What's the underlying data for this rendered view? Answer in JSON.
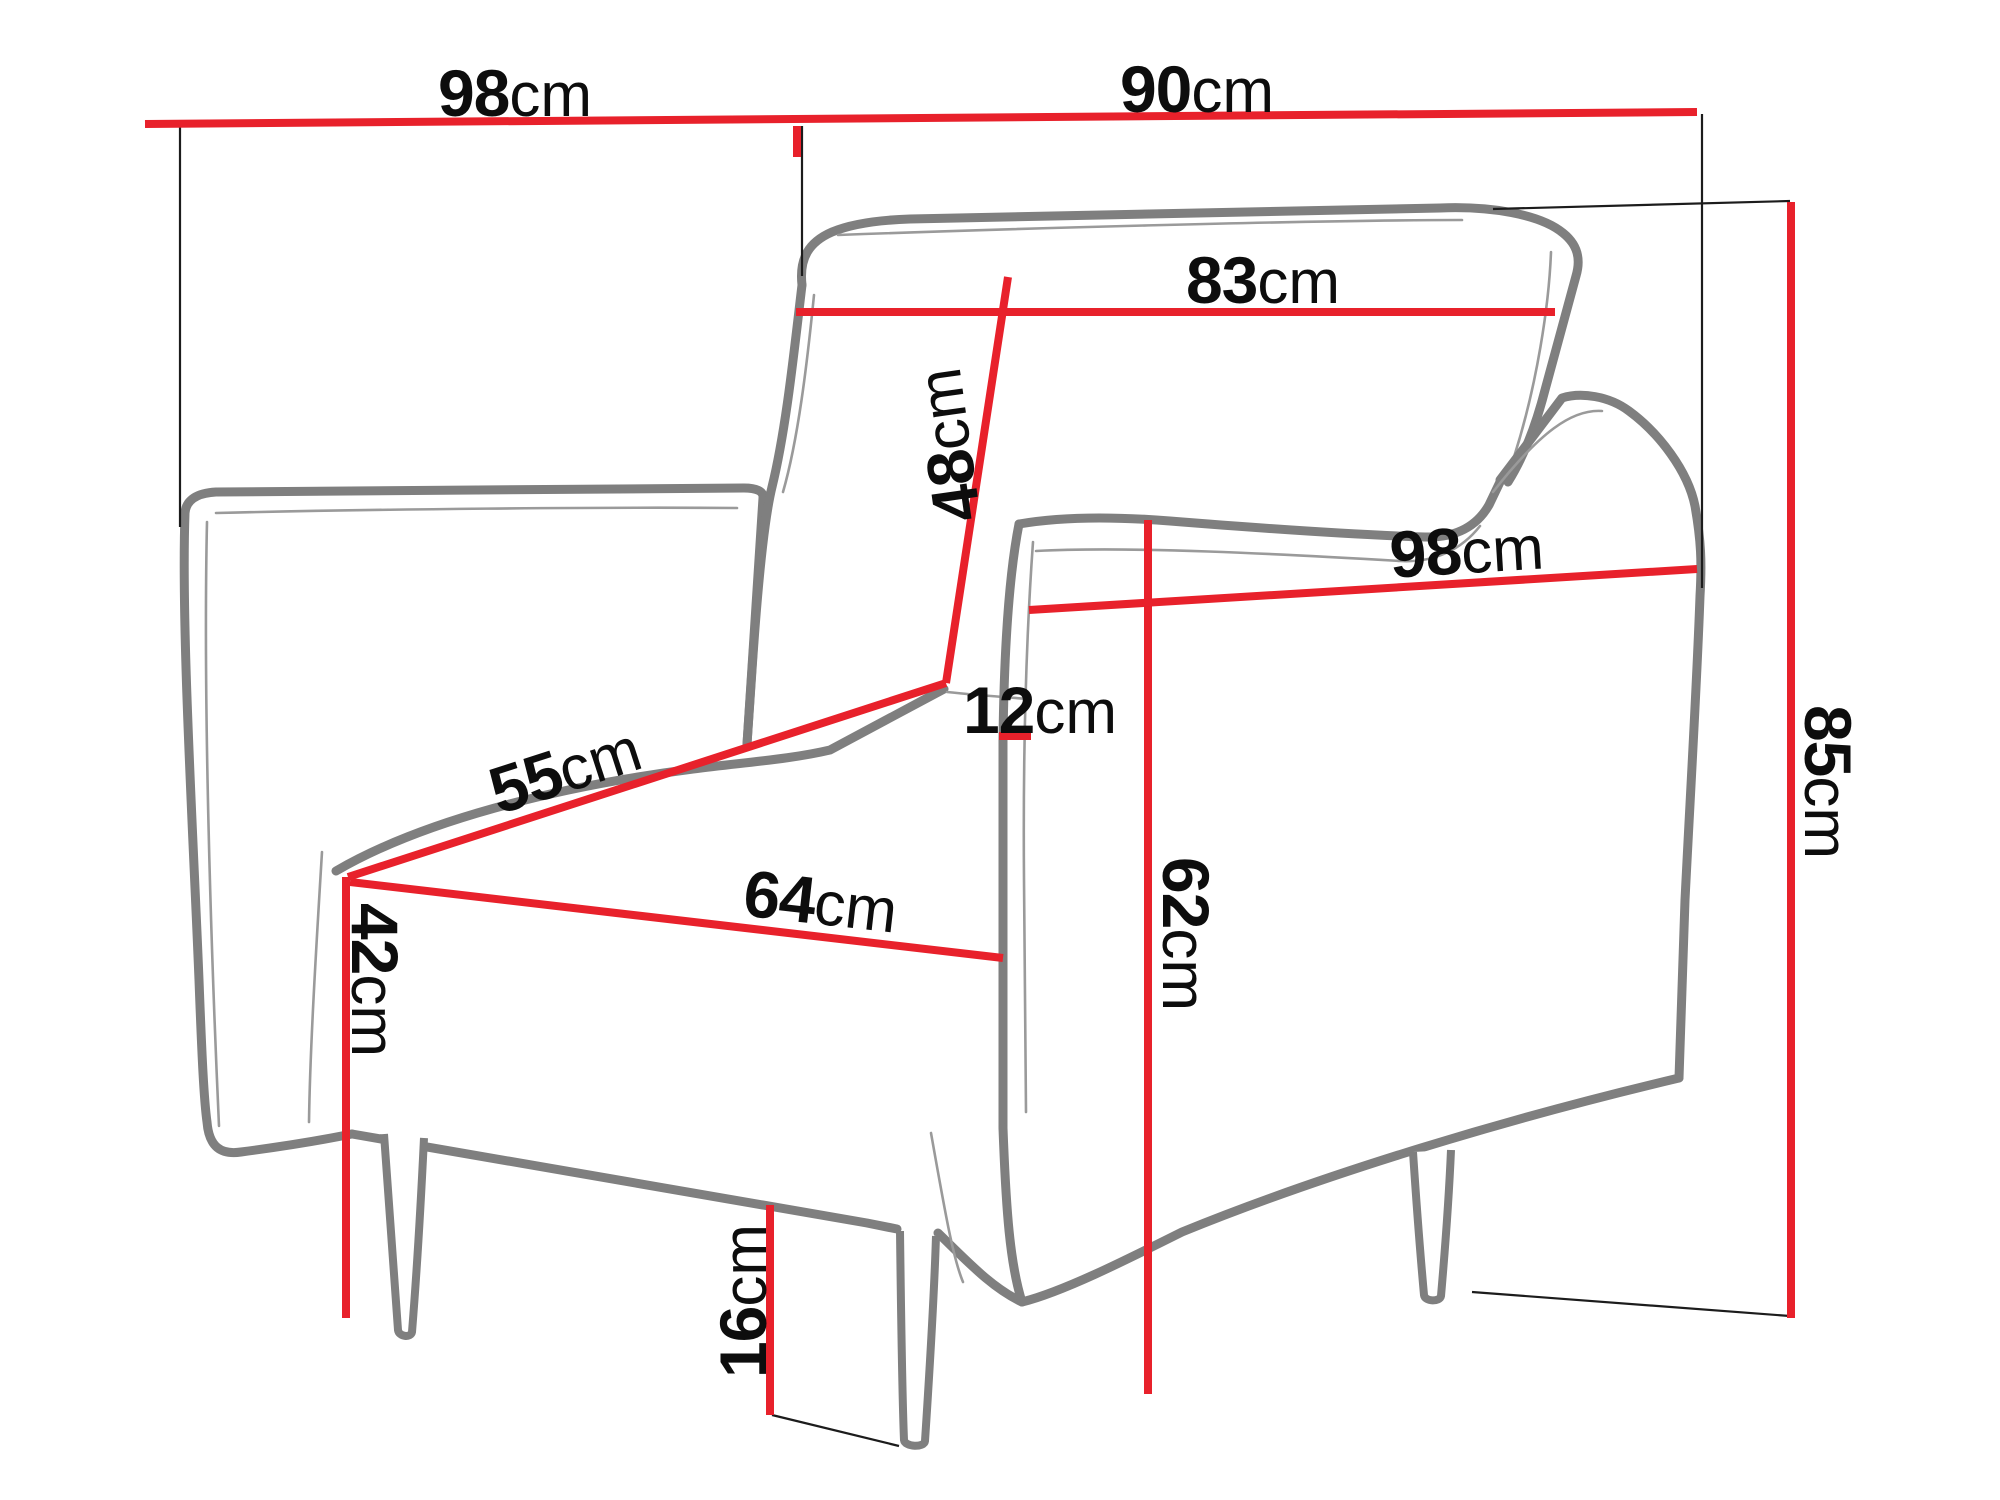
{
  "diagram": {
    "subject": "armchair-dimension-drawing",
    "unit": "cm",
    "colors": {
      "dimension_line": "#e8212b",
      "furniture_outline": "#7f7f7f",
      "extension_line": "#1c1c1c",
      "label_text": "#0d0d0d",
      "background": "#ffffff"
    },
    "dimensions": {
      "top_back_width": {
        "value": "98",
        "unit": "cm"
      },
      "top_depth": {
        "value": "90",
        "unit": "cm"
      },
      "backrest_width": {
        "value": "83",
        "unit": "cm"
      },
      "backrest_height": {
        "value": "48",
        "unit": "cm"
      },
      "seat_side_depth": {
        "value": "55",
        "unit": "cm"
      },
      "seat_front_width": {
        "value": "64",
        "unit": "cm"
      },
      "armrest_gap": {
        "value": "12",
        "unit": "cm"
      },
      "armrest_height": {
        "value": "62",
        "unit": "cm"
      },
      "side_depth": {
        "value": "98",
        "unit": "cm"
      },
      "seat_height": {
        "value": "42",
        "unit": "cm"
      },
      "total_height": {
        "value": "85",
        "unit": "cm"
      },
      "leg_clearance": {
        "value": "16",
        "unit": "cm"
      }
    }
  }
}
